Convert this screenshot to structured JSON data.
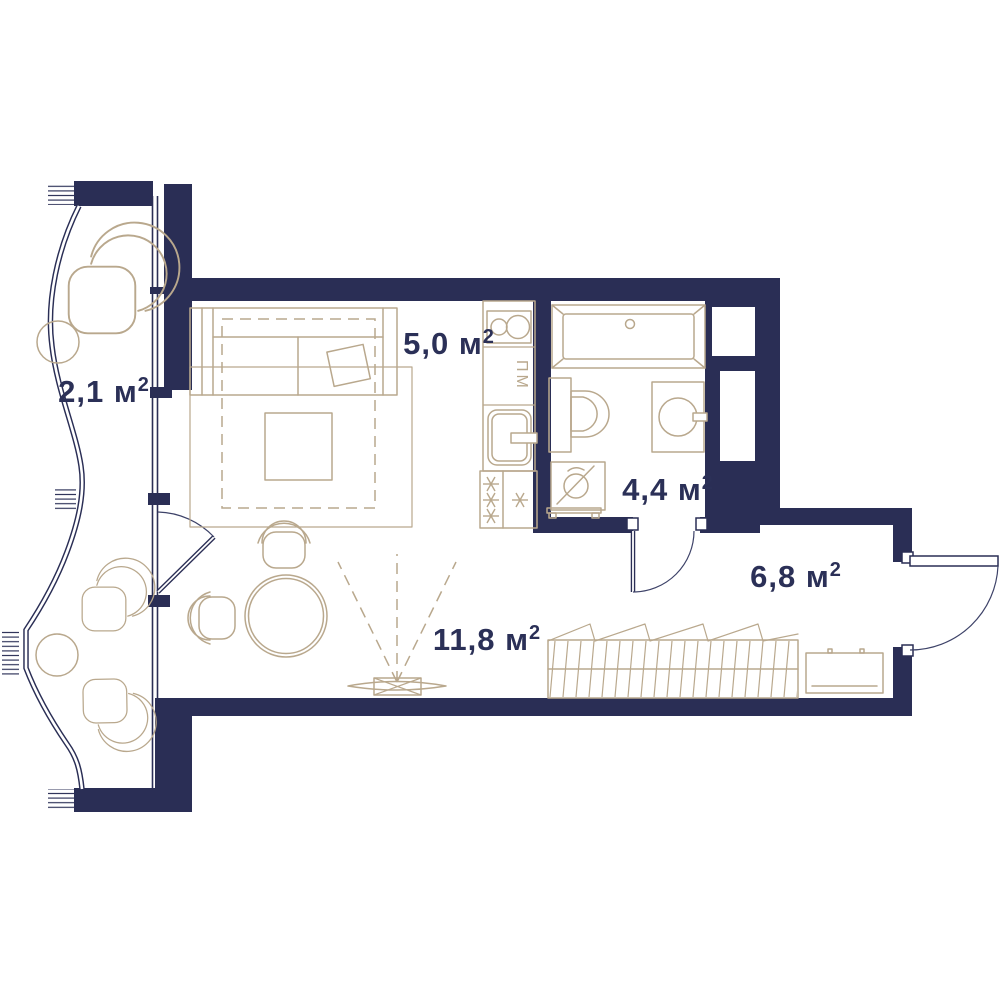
{
  "page": {
    "type": "apartment-floor-plan",
    "units": "м²"
  },
  "colors": {
    "wall": "#2a2e55",
    "furniture": "#b9a88d",
    "text": "#2b3057",
    "arc": "#3d4268",
    "background": "#ffffff"
  },
  "rooms": {
    "balcony": {
      "area_label": "2,1 м",
      "area_sup": "2"
    },
    "living_room": {
      "area_label": "11,8 м",
      "area_sup": "2"
    },
    "kitchen": {
      "area_label": "5,0 м",
      "area_sup": "2"
    },
    "bathroom": {
      "area_label": "4,4 м",
      "area_sup": "2"
    },
    "hallway": {
      "area_label": "6,8 м",
      "area_sup": "2"
    }
  },
  "labels": {
    "dishwasher": "ПМ"
  },
  "fixtures": [
    "sofa",
    "rug",
    "pillow",
    "coffee-table",
    "dining-table",
    "dining-chairs",
    "tv-with-viewing-cone",
    "kitchen-counter",
    "hob",
    "dishwasher",
    "kitchen-sink",
    "stove",
    "bathtub",
    "toilet",
    "washing-machine",
    "washbasin",
    "wardrobe",
    "hallway-cabinet",
    "lounge-chairs",
    "side-tables",
    "entrance-door",
    "bathroom-door",
    "balcony-door",
    "panoramic-balcony-glazing",
    "ventilation-shafts"
  ]
}
